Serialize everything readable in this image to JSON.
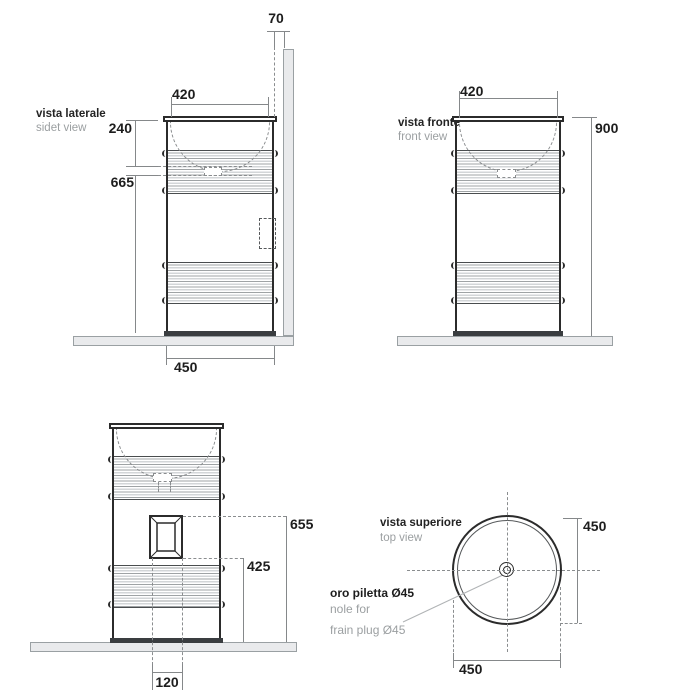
{
  "colors": {
    "outline": "#2b2b2b",
    "dimension_lines": "#85888a",
    "gray_text": "#9b9fa1",
    "surface_fill": "#e9eaec"
  },
  "side_view": {
    "title": "vista laterale",
    "subtitle": "sidet view",
    "dim_wall_gap": "70",
    "dim_top_width": "420",
    "dim_basin_depth": "240",
    "dim_basin_height": "665",
    "dim_base_width": "450"
  },
  "front_view": {
    "title": "vista fronte",
    "subtitle": "front view",
    "dim_top_width": "420",
    "dim_total_height": "900"
  },
  "rear_view": {
    "dim_opening_top": "655",
    "dim_opening_bottom": "425",
    "dim_opening_width": "120"
  },
  "top_view": {
    "title": "vista superiore",
    "subtitle": "top view",
    "dim_depth": "450",
    "dim_width": "450",
    "drain_label_line1": "oro piletta Ø45",
    "drain_label_line2": "nole for",
    "drain_label_line3": "frain plug Ø45"
  }
}
